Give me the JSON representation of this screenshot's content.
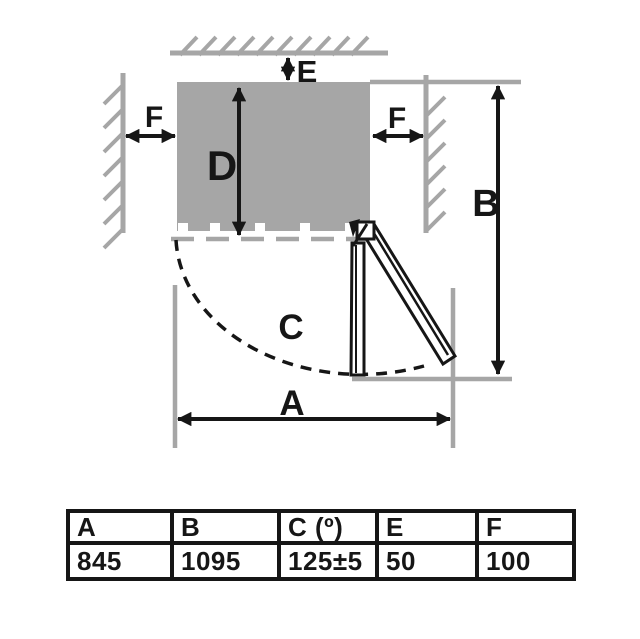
{
  "diagram": {
    "dim_labels": {
      "a": "A",
      "b": "B",
      "c": "C",
      "d": "D",
      "e": "E",
      "f": "F"
    }
  },
  "table": {
    "headers": [
      "A",
      "B",
      "C (º)",
      "E",
      "F"
    ],
    "values": [
      "845",
      "1095",
      "125±5",
      "50",
      "100"
    ]
  },
  "colors": {
    "wall_gray": "#a6a6a6",
    "ink_black": "#161616"
  }
}
